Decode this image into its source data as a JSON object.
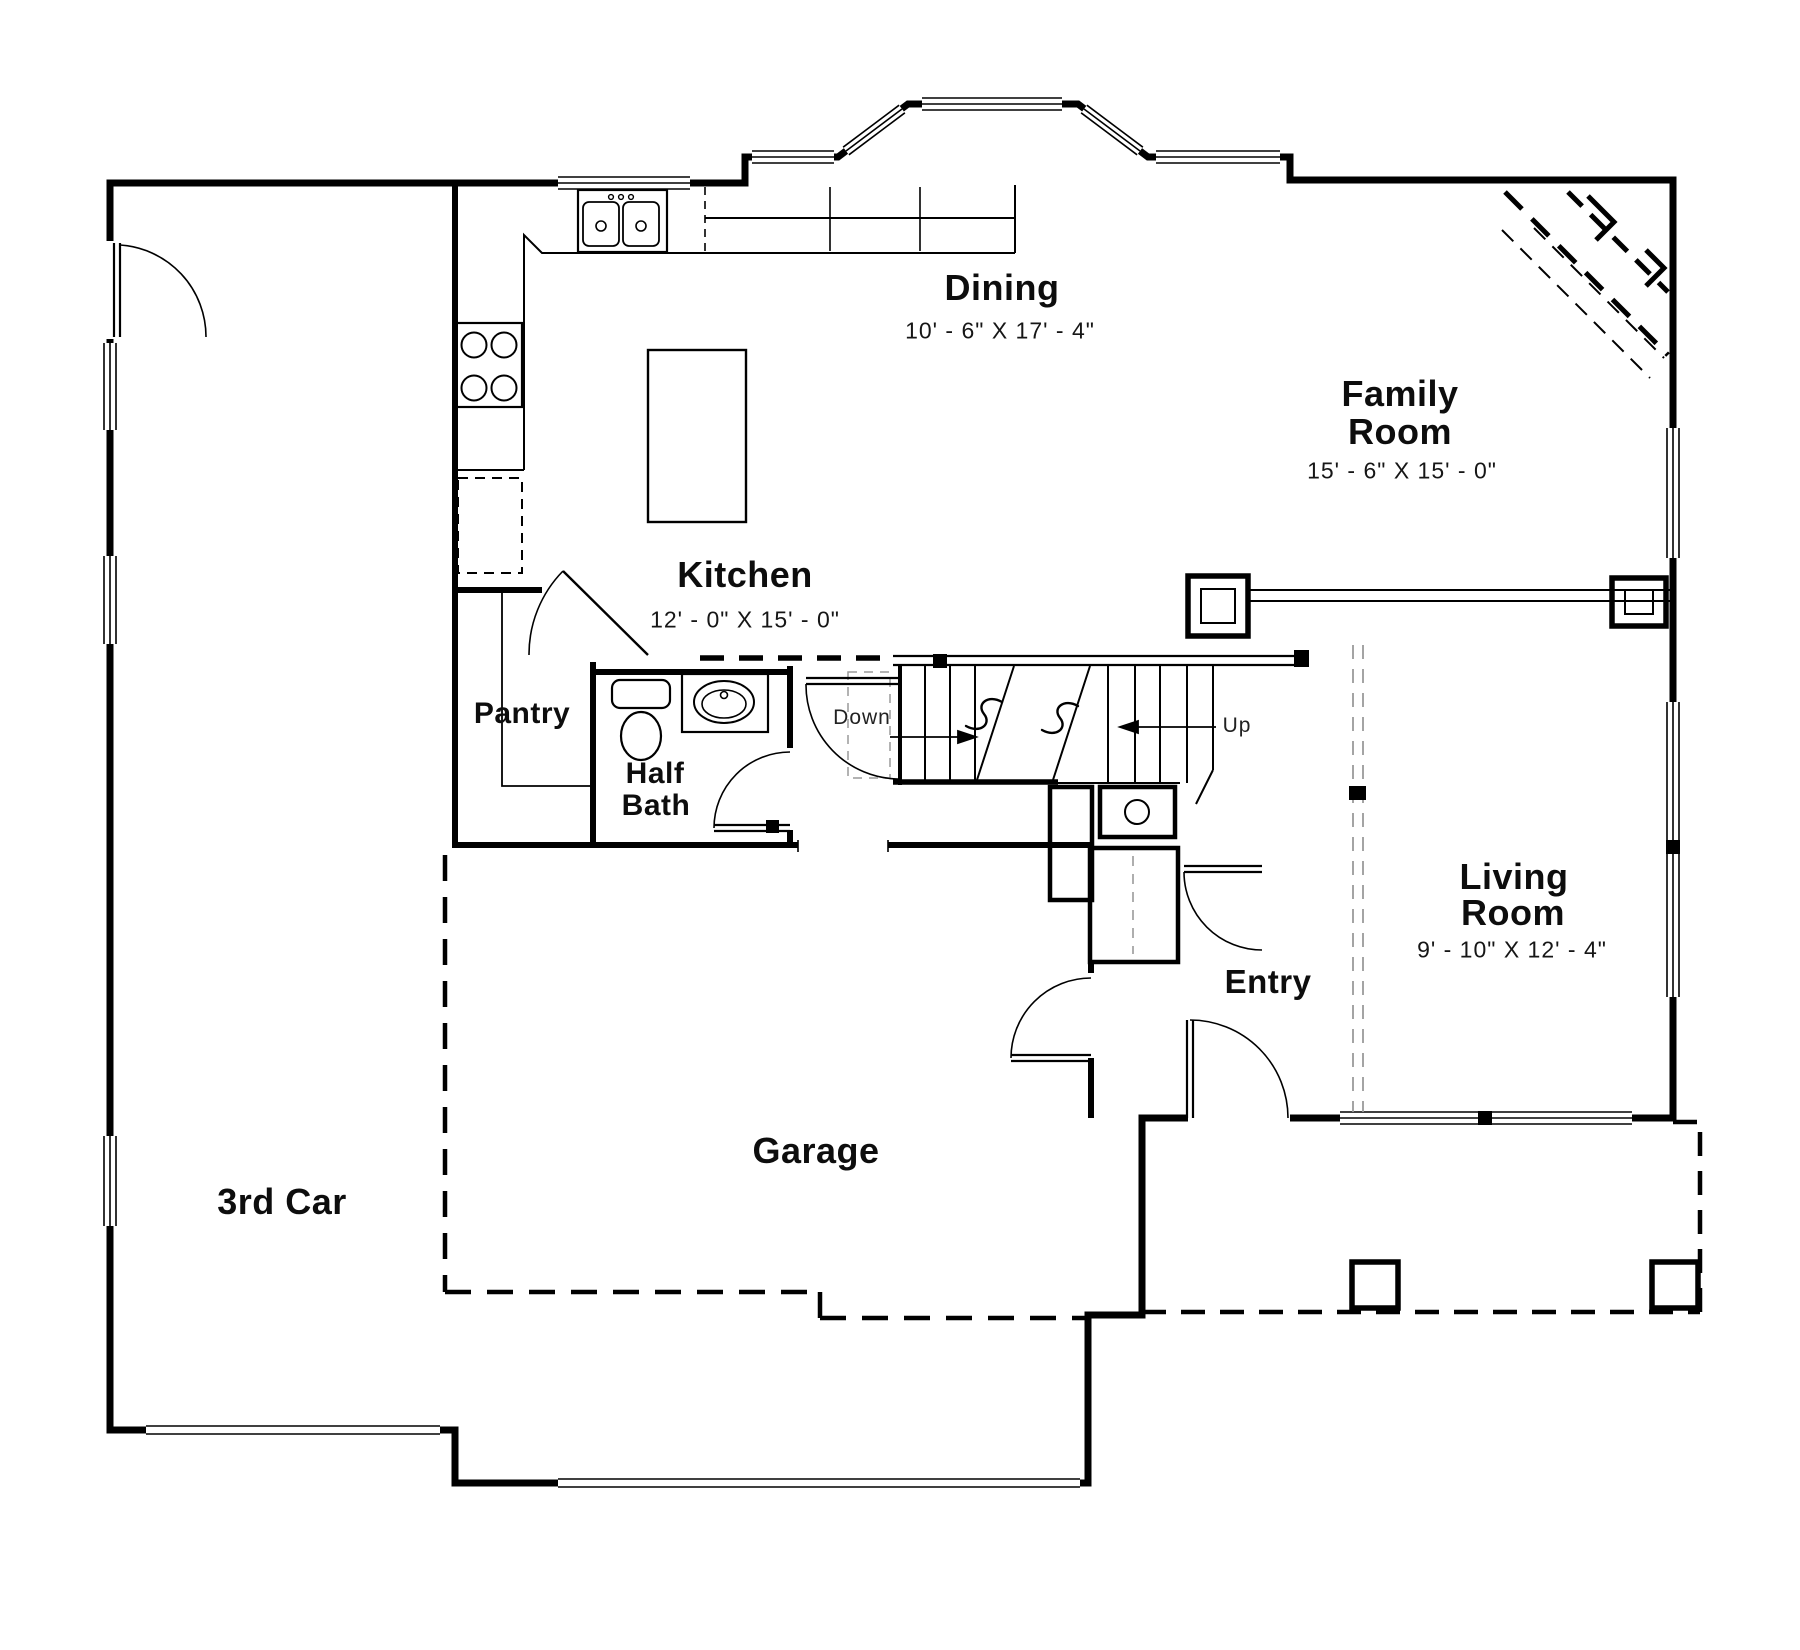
{
  "plan_labels": {
    "dining": {
      "name": "Dining",
      "dims": "10' - 6\" X 17' - 4\""
    },
    "family_room": {
      "line1": "Family",
      "line2": "Room",
      "dims": "15' - 6\" X 15' - 0\""
    },
    "kitchen": {
      "name": "Kitchen",
      "dims": "12' - 0\" X 15' - 0\""
    },
    "pantry": {
      "name": "Pantry"
    },
    "half_bath": {
      "line1": "Half",
      "line2": "Bath"
    },
    "living_room": {
      "line1": "Living",
      "line2": "Room",
      "dims": "9' - 10\" X 12' - 4\""
    },
    "entry": {
      "name": "Entry"
    },
    "garage": {
      "name": "Garage"
    },
    "third_car": {
      "name": "3rd Car"
    },
    "stairs": {
      "down": "Down",
      "up": "Up"
    }
  },
  "colors": {
    "line": "#000000",
    "background": "#ffffff",
    "light_dash": "#9a9a9a"
  }
}
